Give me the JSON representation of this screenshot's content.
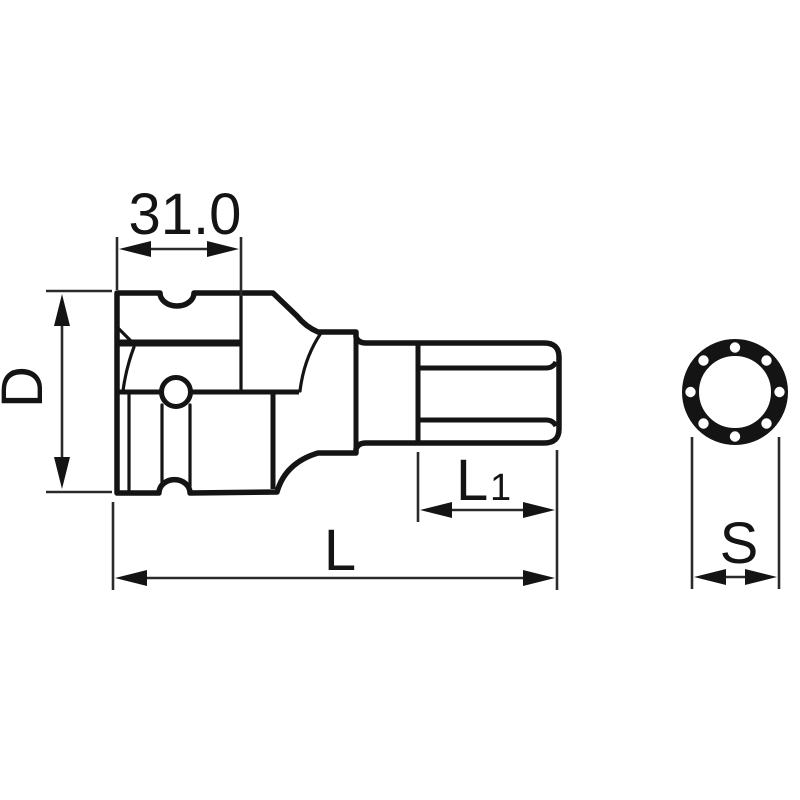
{
  "drawing": {
    "type": "technical-dimension-diagram",
    "subject": "hex-bit-socket",
    "labels": {
      "drive_section_width": "31.0",
      "body_diameter": "D",
      "bit_length_main": "L",
      "bit_length_sub": "1",
      "overall_length": "L",
      "end_size": "S"
    },
    "colors": {
      "line": "#141414",
      "dimension_line": "#2a2a2a",
      "background": "#ffffff"
    }
  }
}
